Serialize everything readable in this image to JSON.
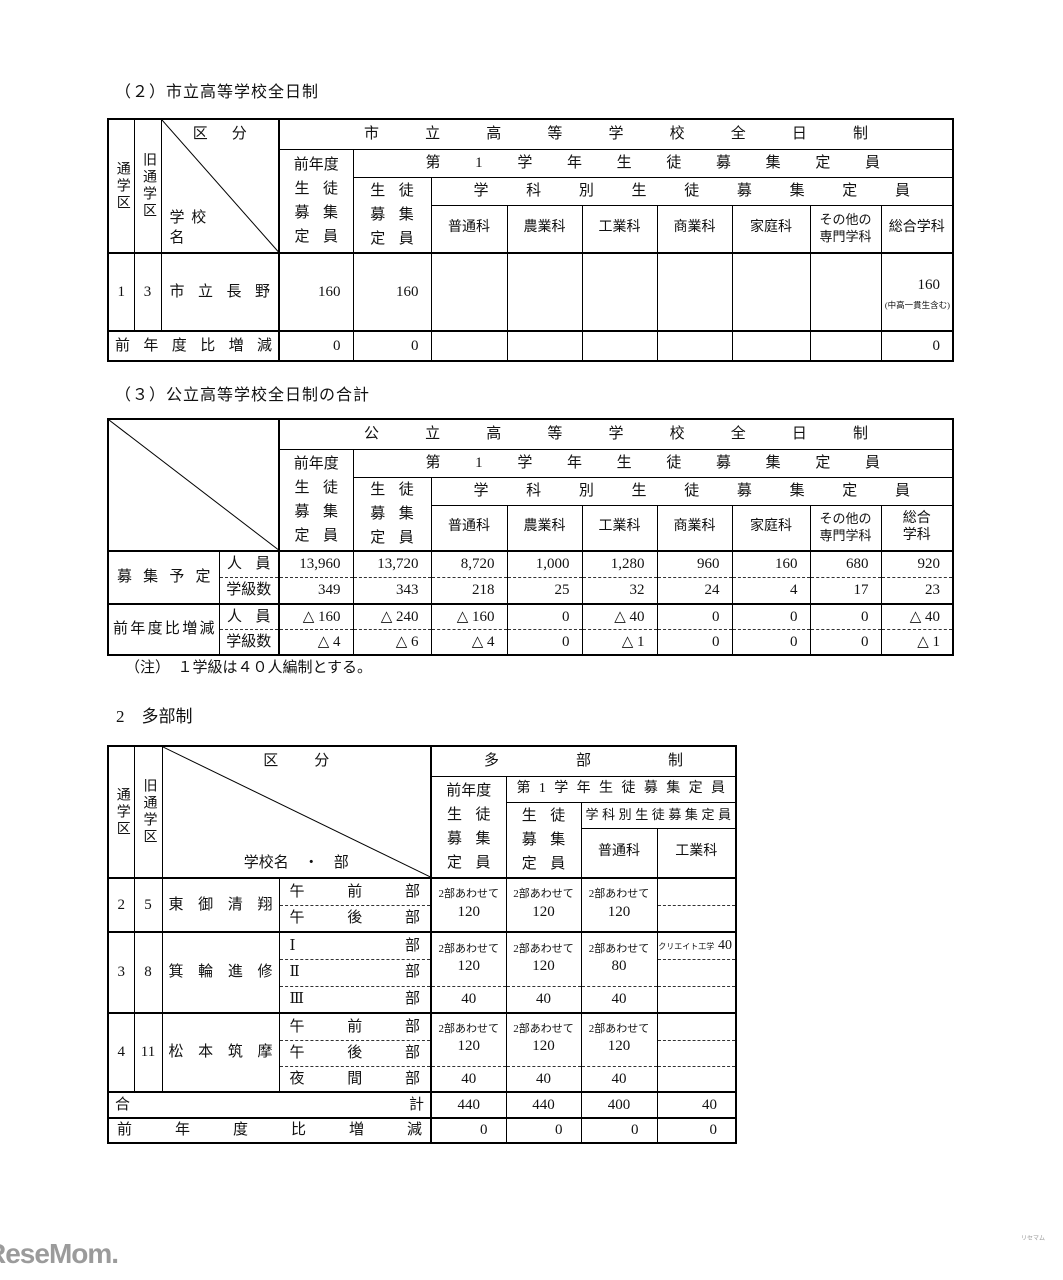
{
  "sections": {
    "title2": "（２）市立高等学校全日制",
    "title3": "（３）公立高等学校全日制の合計",
    "note": "（注）　１学級は４０人編制とする。",
    "title_tabusei": "2　多部制"
  },
  "tableA": {
    "tsugakuku": "通学区",
    "kyutsugakuku": "旧通学区",
    "kubun": "区分",
    "gakkomei": "学校名",
    "top": "市立高等学校全日制",
    "prev_lines": [
      "前年度",
      "生徒",
      "募集",
      "定員"
    ],
    "dai1": "第1学年生徒募集定員",
    "seito_lines": [
      "生徒",
      "募集",
      "定員"
    ],
    "gakkabetsu": "学科別生徒募集定員",
    "subjects": [
      "普通科",
      "農業科",
      "工業科",
      "商業科",
      "家庭科",
      "その他の専門学科",
      "総合学科"
    ],
    "row": {
      "a": "1",
      "b": "3",
      "name": "市立長野",
      "prev": "160",
      "first": "160",
      "sogo": "160",
      "sogo_note": "(中高一貫生含む)"
    },
    "diff_label": "前年度比増減",
    "diff": {
      "prev": "0",
      "first": "0",
      "sogo": "0"
    }
  },
  "tableB": {
    "top": "公立高等学校全日制",
    "prev_lines": [
      "前年度",
      "生徒",
      "募集",
      "定員"
    ],
    "dai1": "第1学年生徒募集定員",
    "seito_lines": [
      "生徒",
      "募集",
      "定員"
    ],
    "gakkabetsu": "学科別生徒募集定員",
    "subjects": [
      "普通科",
      "農業科",
      "工業科",
      "商業科",
      "家庭科",
      "その他の専門学科",
      "総合学科"
    ],
    "boshu_label": "募集予定",
    "jinin_label": "人員",
    "gakkyu_label": "学級数",
    "boshu_jinin": [
      "13,960",
      "13,720",
      "8,720",
      "1,000",
      "1,280",
      "960",
      "160",
      "680",
      "920"
    ],
    "boshu_gakkyu": [
      "349",
      "343",
      "218",
      "25",
      "32",
      "24",
      "4",
      "17",
      "23"
    ],
    "diff_label": "前年度比増減",
    "diff_jinin": [
      "△ 160",
      "△ 240",
      "△ 160",
      "0",
      "△ 40",
      "0",
      "0",
      "0",
      "△ 40"
    ],
    "diff_gakkyu": [
      "△ 4",
      "△ 6",
      "△ 4",
      "0",
      "△ 1",
      "0",
      "0",
      "0",
      "△ 1"
    ]
  },
  "tableC": {
    "tsugakuku": "通学区",
    "kyutsugakuku": "旧通学区",
    "kubun": "区分",
    "gakkomei_bu": "学校名　・　部",
    "top": "多部制",
    "prev_lines": [
      "前年度",
      "生徒",
      "募集",
      "定員"
    ],
    "dai1": "第1学年生徒募集定員",
    "seito_lines": [
      "生徒",
      "募集",
      "定員"
    ],
    "gakkabetsu": "学科別生徒募集定員",
    "subjects": [
      "普通科",
      "工業科"
    ],
    "g1": {
      "a": "2",
      "b": "5",
      "name": "東御清翔",
      "p1": "午前部",
      "p2": "午後部",
      "v1": {
        "l": "2部あわせて",
        "n": "120"
      },
      "v2": {
        "l": "2部あわせて",
        "n": "120"
      },
      "v3": {
        "l": "2部あわせて",
        "n": "120"
      }
    },
    "g2": {
      "a": "3",
      "b": "8",
      "name": "箕輪進修",
      "p1": "Ⅰ部",
      "p2": "Ⅱ部",
      "p3": "Ⅲ部",
      "v1": {
        "l": "2部あわせて",
        "n": "120"
      },
      "v2": {
        "l": "2部あわせて",
        "n": "120"
      },
      "v3": {
        "l": "2部あわせて",
        "n": "80"
      },
      "kougyo": {
        "l": "クリエイト工学",
        "n": "40"
      },
      "r3": [
        "40",
        "40",
        "40"
      ]
    },
    "g3": {
      "a": "4",
      "b": "11",
      "name": "松本筑摩",
      "p1": "午前部",
      "p2": "午後部",
      "p3": "夜間部",
      "v1": {
        "l": "2部あわせて",
        "n": "120"
      },
      "v2": {
        "l": "2部あわせて",
        "n": "120"
      },
      "v3": {
        "l": "2部あわせて",
        "n": "120"
      },
      "r3": [
        "40",
        "40",
        "40"
      ]
    },
    "total": {
      "label": "合計",
      "values": [
        "440",
        "440",
        "400",
        "40"
      ]
    },
    "diff": {
      "label": "前年度比増減",
      "values": [
        "0",
        "0",
        "0",
        "0"
      ]
    }
  },
  "logo": {
    "brand": "ReseMom.",
    "ruby": "リセマム"
  }
}
